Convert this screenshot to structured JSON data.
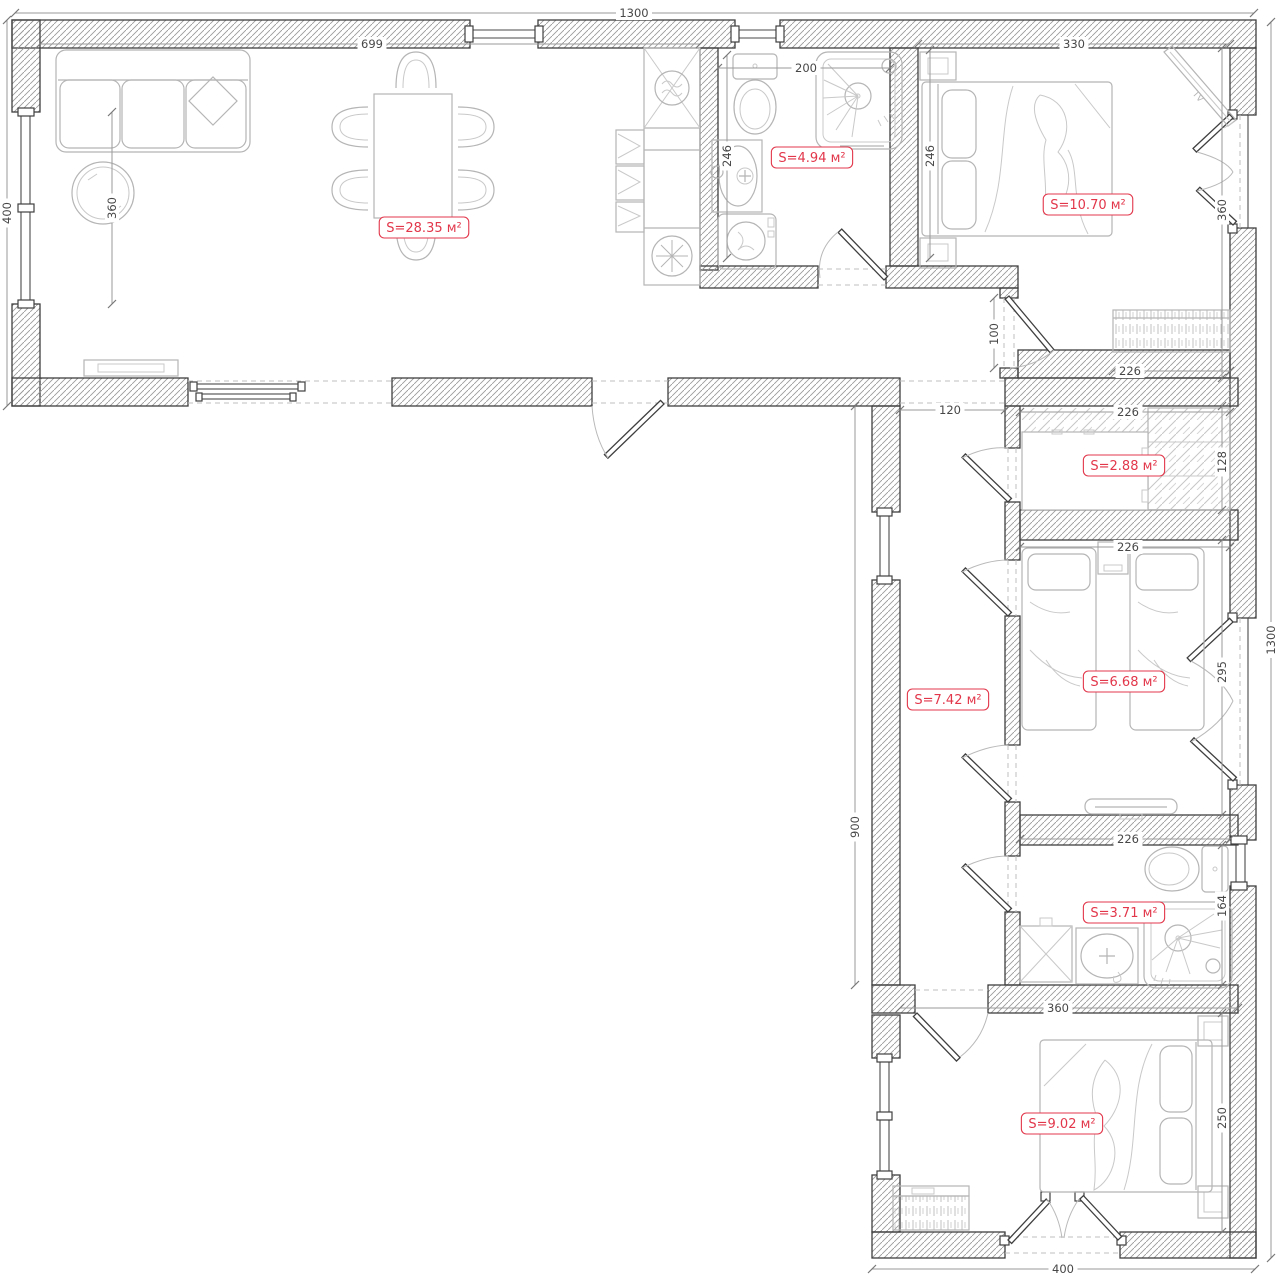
{
  "plan": {
    "type": "apartment-floor-plan",
    "accent_color": "#e2374b",
    "wall_color": "#3f3f3f",
    "area_unit": "м²",
    "tv_label": "TV"
  },
  "rooms": [
    {
      "name": "living-dining-room",
      "label": "S=28.35 м²",
      "area": "28.35",
      "cx": 424,
      "cy": 228
    },
    {
      "name": "bathroom-1",
      "label": "S=4.94 м²",
      "area": "4.94",
      "cx": 812,
      "cy": 158
    },
    {
      "name": "bedroom-1",
      "label": "S=10.70 м²",
      "area": "10.70",
      "cx": 1088,
      "cy": 205
    },
    {
      "name": "storage",
      "label": "S=2.88 м²",
      "area": "2.88",
      "cx": 1124,
      "cy": 466
    },
    {
      "name": "hallway",
      "label": "S=7.42 м²",
      "area": "7.42",
      "cx": 948,
      "cy": 700
    },
    {
      "name": "kids-bedroom",
      "label": "S=6.68 м²",
      "area": "6.68",
      "cx": 1124,
      "cy": 682
    },
    {
      "name": "bathroom-2",
      "label": "S=3.71 м²",
      "area": "3.71",
      "cx": 1124,
      "cy": 913
    },
    {
      "name": "bedroom-2",
      "label": "S=9.02 м²",
      "area": "9.02",
      "cx": 1062,
      "cy": 1124
    }
  ],
  "dimensions": [
    {
      "label": "1300",
      "x1": 15,
      "y1": 13,
      "x2": 1254,
      "y2": 13,
      "tx": 634,
      "ty": 13,
      "v": false
    },
    {
      "label": "1300",
      "x1": 1271,
      "y1": 22,
      "x2": 1271,
      "y2": 1258,
      "tx": 1271,
      "ty": 640,
      "v": true
    },
    {
      "label": "400",
      "x1": 7,
      "y1": 20,
      "x2": 7,
      "y2": 406,
      "tx": 7,
      "ty": 213,
      "v": true
    },
    {
      "label": "400",
      "x1": 872,
      "y1": 1269,
      "x2": 1255,
      "y2": 1269,
      "tx": 1063,
      "ty": 1269,
      "v": false
    },
    {
      "label": "699",
      "x1": 40,
      "y1": 44,
      "x2": 700,
      "y2": 44,
      "tx": 372,
      "ty": 44,
      "v": false
    },
    {
      "label": "360",
      "x1": 112,
      "y1": 112,
      "x2": 112,
      "y2": 304,
      "tx": 112,
      "ty": 208,
      "v": true
    },
    {
      "label": "200",
      "x1": 718,
      "y1": 68,
      "x2": 890,
      "y2": 68,
      "tx": 806,
      "ty": 68,
      "v": false
    },
    {
      "label": "246",
      "x1": 727,
      "y1": 55,
      "x2": 727,
      "y2": 258,
      "tx": 727,
      "ty": 156,
      "v": true
    },
    {
      "label": "246",
      "x1": 930,
      "y1": 50,
      "x2": 930,
      "y2": 258,
      "tx": 930,
      "ty": 156,
      "v": true
    },
    {
      "label": "330",
      "x1": 918,
      "y1": 44,
      "x2": 1230,
      "y2": 44,
      "tx": 1074,
      "ty": 44,
      "v": false
    },
    {
      "label": "360",
      "x1": 1222,
      "y1": 48,
      "x2": 1222,
      "y2": 378,
      "tx": 1222,
      "ty": 210,
      "v": true
    },
    {
      "label": "100",
      "x1": 994,
      "y1": 298,
      "x2": 994,
      "y2": 368,
      "tx": 994,
      "ty": 334,
      "v": true
    },
    {
      "label": "226",
      "x1": 1113,
      "y1": 371,
      "x2": 1230,
      "y2": 371,
      "tx": 1130,
      "ty": 371,
      "v": false
    },
    {
      "label": "120",
      "x1": 900,
      "y1": 410,
      "x2": 1005,
      "y2": 410,
      "tx": 950,
      "ty": 410,
      "v": false
    },
    {
      "label": "226",
      "x1": 1020,
      "y1": 412,
      "x2": 1230,
      "y2": 412,
      "tx": 1128,
      "ty": 412,
      "v": false
    },
    {
      "label": "128",
      "x1": 1222,
      "y1": 406,
      "x2": 1222,
      "y2": 510,
      "tx": 1222,
      "ty": 462,
      "v": true
    },
    {
      "label": "226",
      "x1": 1020,
      "y1": 547,
      "x2": 1230,
      "y2": 547,
      "tx": 1128,
      "ty": 547,
      "v": false
    },
    {
      "label": "295",
      "x1": 1222,
      "y1": 540,
      "x2": 1222,
      "y2": 815,
      "tx": 1222,
      "ty": 672,
      "v": true
    },
    {
      "label": "900",
      "x1": 855,
      "y1": 406,
      "x2": 855,
      "y2": 985,
      "tx": 855,
      "ty": 827,
      "v": true
    },
    {
      "label": "226",
      "x1": 1020,
      "y1": 839,
      "x2": 1230,
      "y2": 839,
      "tx": 1128,
      "ty": 839,
      "v": false
    },
    {
      "label": "164",
      "x1": 1222,
      "y1": 845,
      "x2": 1222,
      "y2": 985,
      "tx": 1222,
      "ty": 906,
      "v": true
    },
    {
      "label": "360",
      "x1": 900,
      "y1": 1008,
      "x2": 1238,
      "y2": 1008,
      "tx": 1058,
      "ty": 1008,
      "v": false
    },
    {
      "label": "250",
      "x1": 1222,
      "y1": 1013,
      "x2": 1222,
      "y2": 1232,
      "tx": 1222,
      "ty": 1118,
      "v": true
    }
  ]
}
